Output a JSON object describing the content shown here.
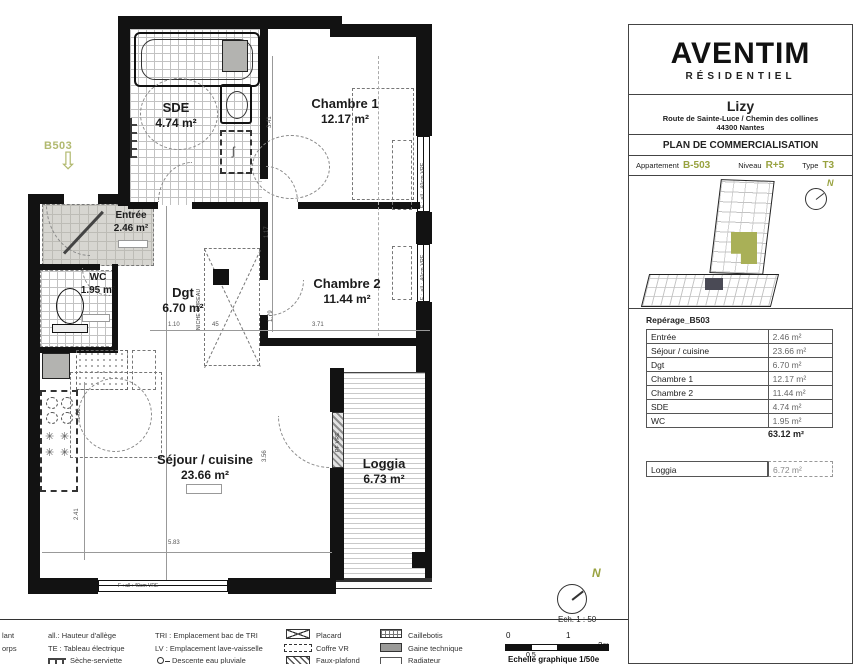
{
  "colors": {
    "accent": "#98a23f"
  },
  "titleblock": {
    "brand": "AVENTIM",
    "brand_sub": "RÉSIDENTIEL",
    "project_name": "Lizy",
    "project_address": "Route de Sainte-Luce / Chemin des collines",
    "project_city": "44300 Nantes",
    "doc_title": "PLAN DE COMMERCIALISATION",
    "info": {
      "apartment_label": "Appartement",
      "apartment_value": "B-503",
      "level_label": "Niveau",
      "level_value": "R+5",
      "type_label": "Type",
      "type_value": "T3"
    },
    "table": {
      "title": "Repérage_B503",
      "rows": [
        {
          "room": "Entrée",
          "area": "2.46 m²"
        },
        {
          "room": "Séjour / cuisine",
          "area": "23.66 m²"
        },
        {
          "room": "Dgt",
          "area": "6.70 m²"
        },
        {
          "room": "Chambre 1",
          "area": "12.17 m²"
        },
        {
          "room": "Chambre 2",
          "area": "11.44 m²"
        },
        {
          "room": "SDE",
          "area": "4.74 m²"
        },
        {
          "room": "WC",
          "area": "1.95 m²"
        }
      ],
      "total": "63.12 m²",
      "loggia": {
        "room": "Loggia",
        "area": "6.72 m²"
      }
    }
  },
  "plan": {
    "unit_tag": "B503",
    "rooms": {
      "sde": {
        "name": "SDE",
        "area": "4.74 m²"
      },
      "ch1": {
        "name": "Chambre 1",
        "area": "12.17 m²"
      },
      "entree": {
        "name": "Entrée",
        "area": "2.46 m²"
      },
      "wc": {
        "name": "WC",
        "area": "1.95 m²"
      },
      "dgt": {
        "name": "Dgt",
        "area": "6.70 m²"
      },
      "ch2": {
        "name": "Chambre 2",
        "area": "11.44 m²"
      },
      "sejour": {
        "name": "Séjour / cuisine",
        "area": "23.66 m²"
      },
      "loggia": {
        "name": "Loggia",
        "area": "6.73 m²"
      }
    },
    "dims": {
      "d1": "3.41",
      "d2": "1.17",
      "d3": "1.79",
      "d4": "1.10",
      "d5": "45",
      "d6": "3.71",
      "d7": "3.56",
      "d8": "5.83",
      "d9": "1.86",
      "d10": "2.41"
    },
    "window_label": "F : all : 40cm VRE",
    "pf_label": "PF VRE",
    "niche_label": "NICHE BUREAU",
    "north": "N",
    "scale": "Ech. 1 : 50"
  },
  "scalebar": {
    "t0": "0",
    "t05": "0,5",
    "t1": "1",
    "t2": "2m",
    "caption": "Echelle graphique 1/50e"
  },
  "legend": {
    "col1": [
      "lant",
      "orps"
    ],
    "col2": [
      "all.: Hauteur d'allège",
      "TE : Tableau électrique",
      "Sèche-serviette"
    ],
    "col3": [
      "TRI : Emplacement bac de TRI",
      "LV : Emplacement lave-vaisselle",
      "Descente eau pluviale"
    ],
    "col4": [
      "Placard",
      "Coffre VR",
      "Faux-plafond"
    ],
    "col5": [
      "Caillebotis",
      "Gaine technique",
      "Radiateur"
    ]
  }
}
